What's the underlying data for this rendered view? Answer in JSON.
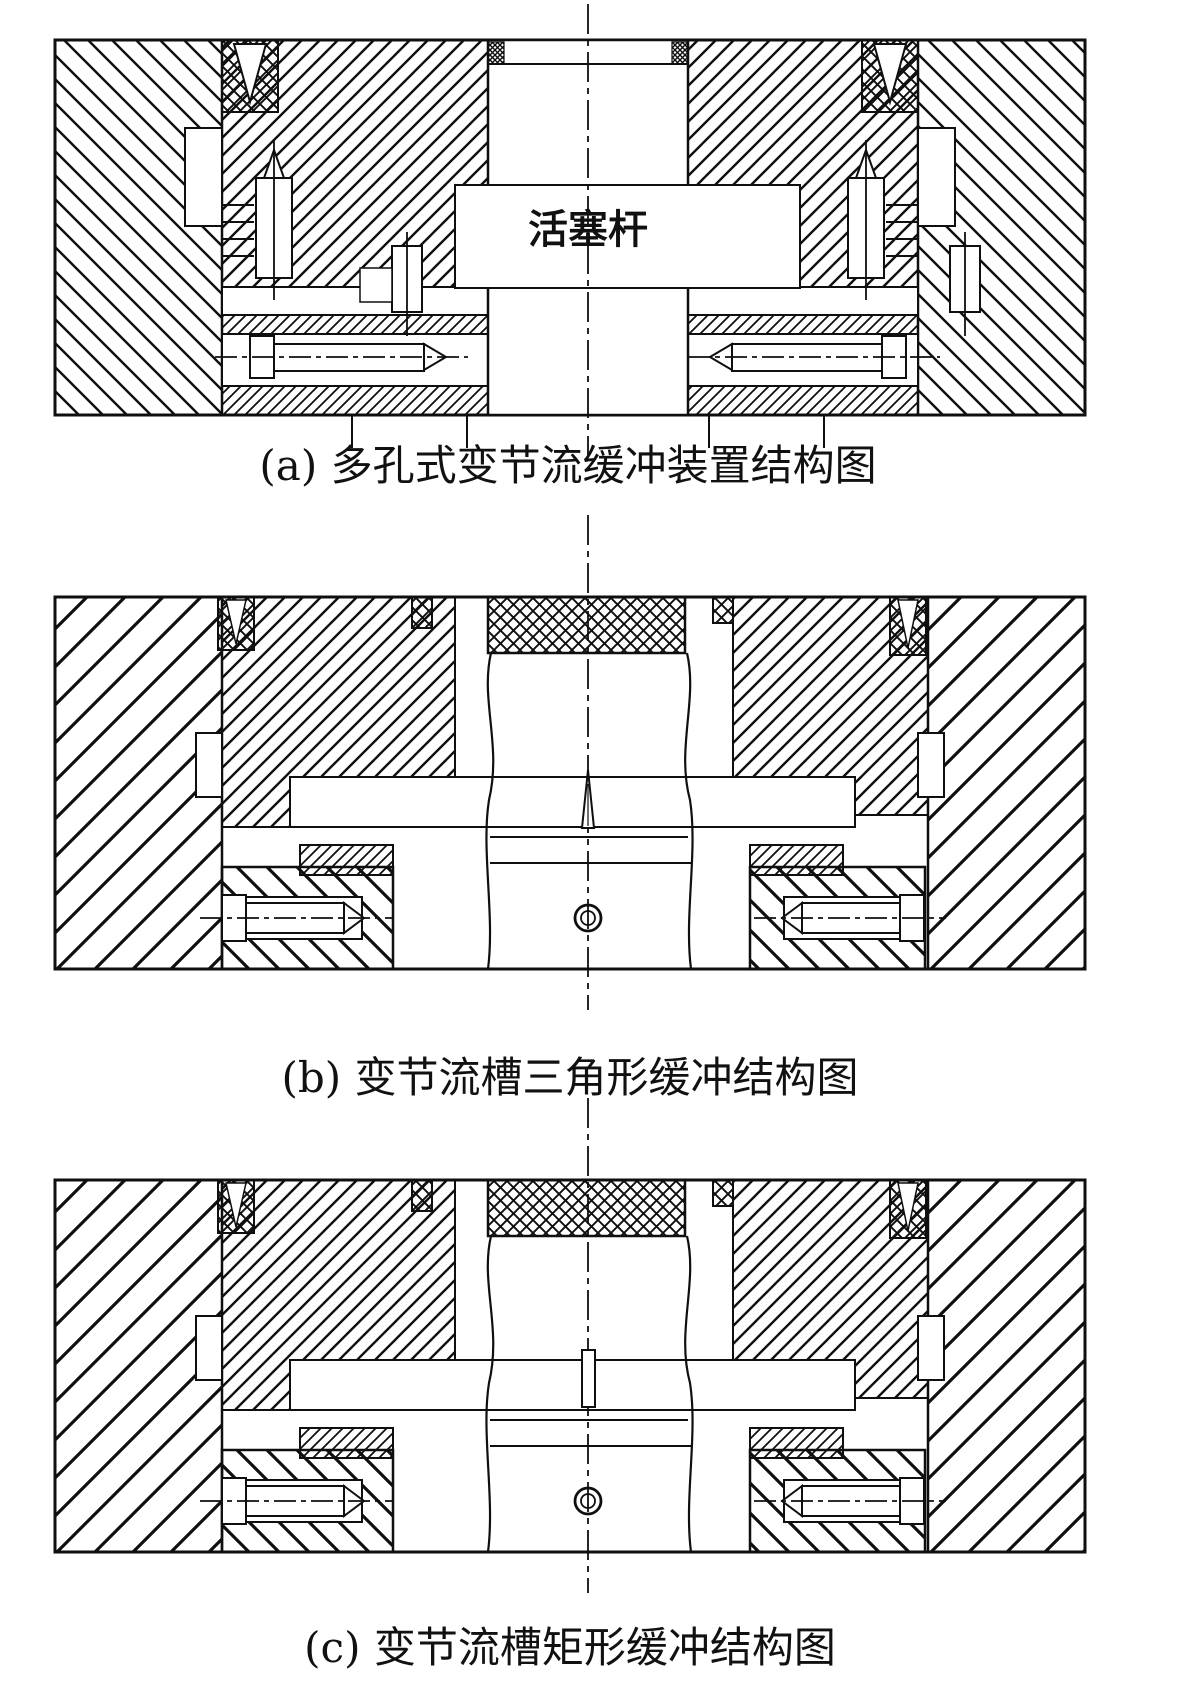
{
  "figures": [
    {
      "id": "a",
      "caption": "(a) 多孔式变节流缓冲装置结构图",
      "label": "活塞杆",
      "description_type": "multi-hole variable throttle cushion device"
    },
    {
      "id": "b",
      "caption": "(b) 变节流槽三角形缓冲结构图",
      "description_type": "triangular variable throttle groove cushion"
    },
    {
      "id": "c",
      "caption": "(c) 变节流槽矩形缓冲结构图",
      "description_type": "rectangular variable throttle groove cushion"
    }
  ],
  "colors": {
    "line": "#0f0f0f",
    "background": "#ffffff"
  }
}
